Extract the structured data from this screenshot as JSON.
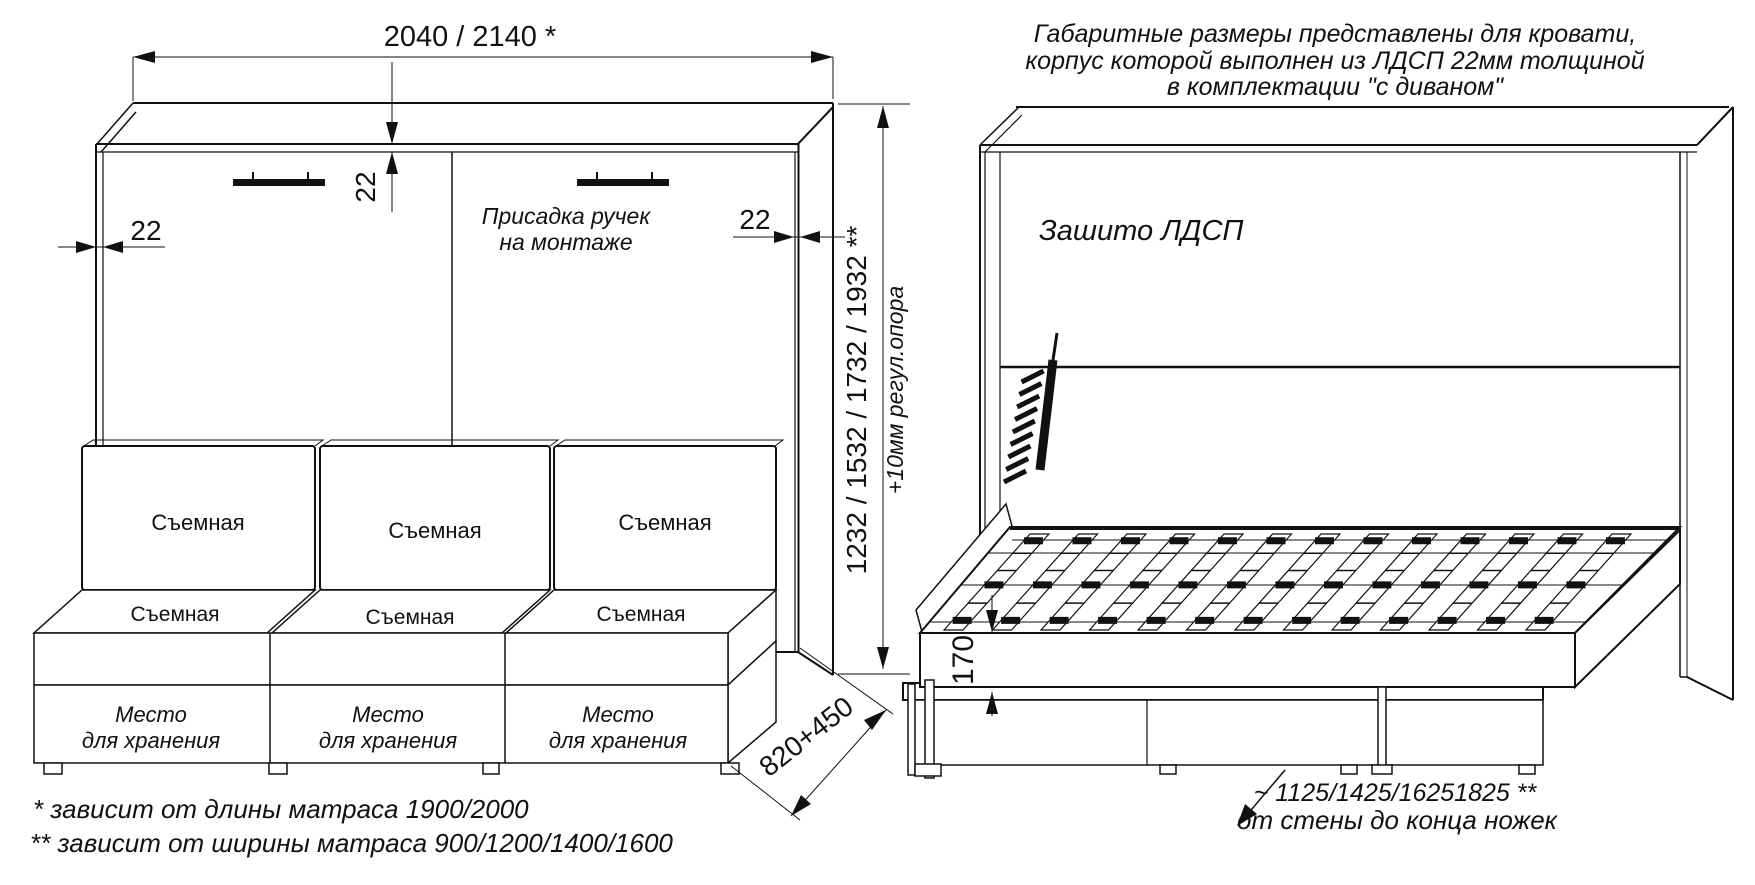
{
  "title_note": {
    "line1": "Габаритные размеры представлены для кровати,",
    "line2": "корпус которой выполнен из ЛДСП 22мм толщиной",
    "line3": "в комплектации \"с диваном\""
  },
  "closed_view": {
    "width_dim": "2040 / 2140 *",
    "top_thickness": "22",
    "left_thickness": "22",
    "right_thickness": "22",
    "height_dim": "1232 / 1532 / 1732 / 1932 **",
    "height_note": "+10мм регул.опора",
    "handle_note_line1": "Присадка ручек",
    "handle_note_line2": "на монтаже",
    "depth_dim": "820+450",
    "cushion_label": "Съемная",
    "storage_label_line1": "Место",
    "storage_label_line2": "для хранения"
  },
  "open_view": {
    "panel_label": "Зашито ЛДСП",
    "frame_height_dim": "170",
    "floor_dim": "~ 1125/1425/16251825 **",
    "floor_dim_note": "от стены до конца ножек"
  },
  "footnotes": {
    "line1": "*  зависит от длины матраса 1900/2000",
    "line2": "** зависит от ширины матраса 900/1200/1400/1600"
  },
  "colors": {
    "line": "#111111",
    "background": "#ffffff"
  }
}
